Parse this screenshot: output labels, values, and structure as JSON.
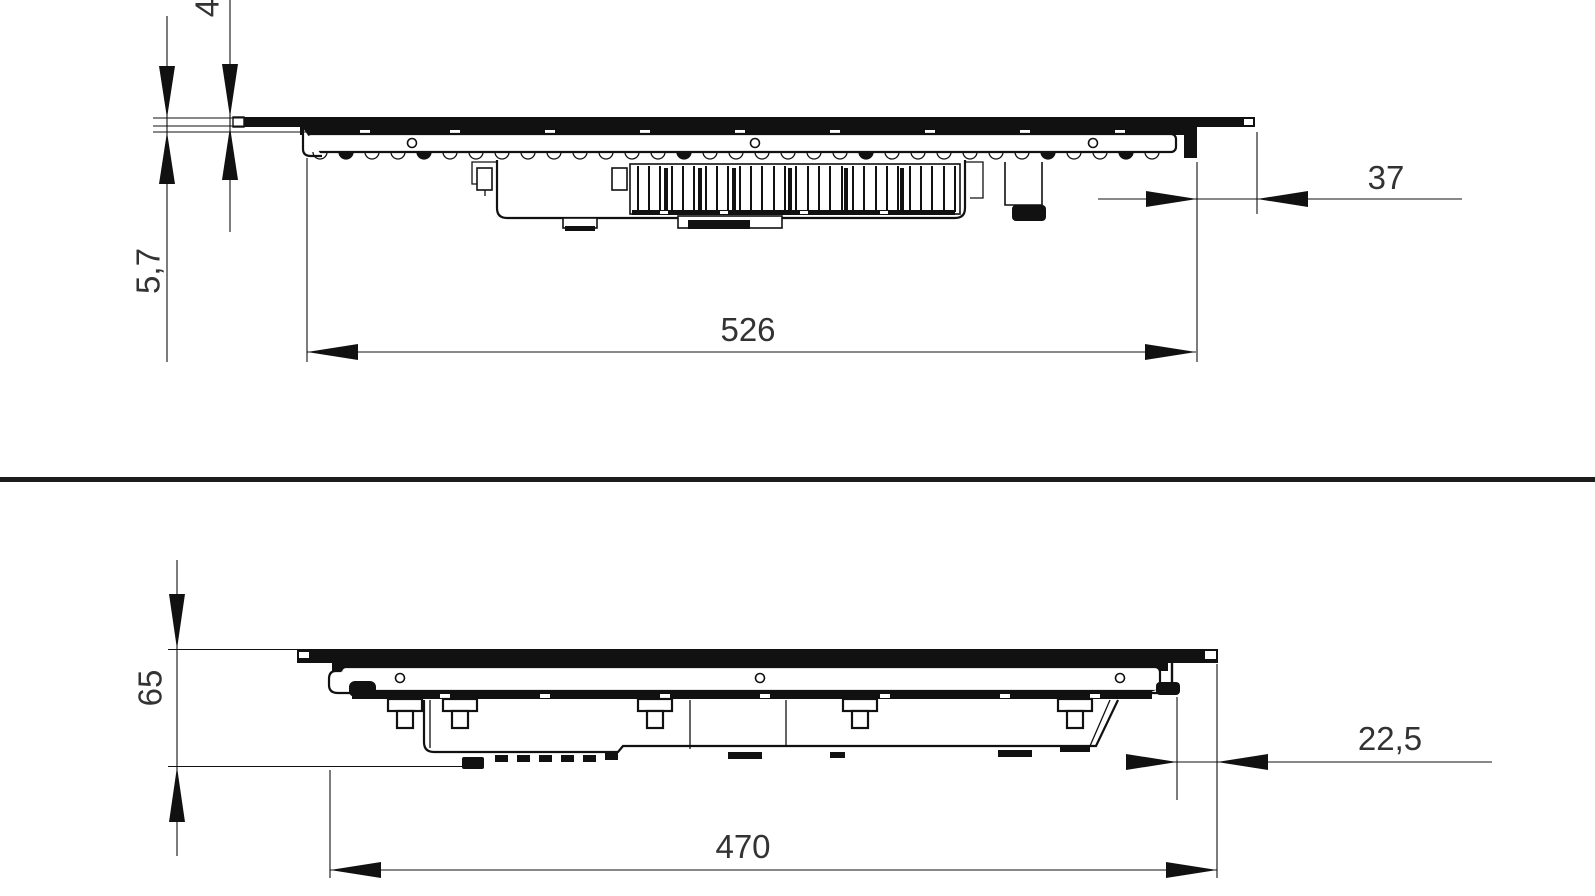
{
  "drawing": {
    "type": "technical-side-views-cooktop",
    "colors": {
      "line": "#111111",
      "text": "#333333",
      "background": "#ffffff"
    },
    "top_view": {
      "dims": {
        "glass_thickness": "4",
        "profile_height": "5,7",
        "body_width": "526",
        "right_offset": "37"
      }
    },
    "bottom_view": {
      "dims": {
        "total_height": "65",
        "body_depth": "470",
        "right_offset": "22,5"
      }
    }
  }
}
